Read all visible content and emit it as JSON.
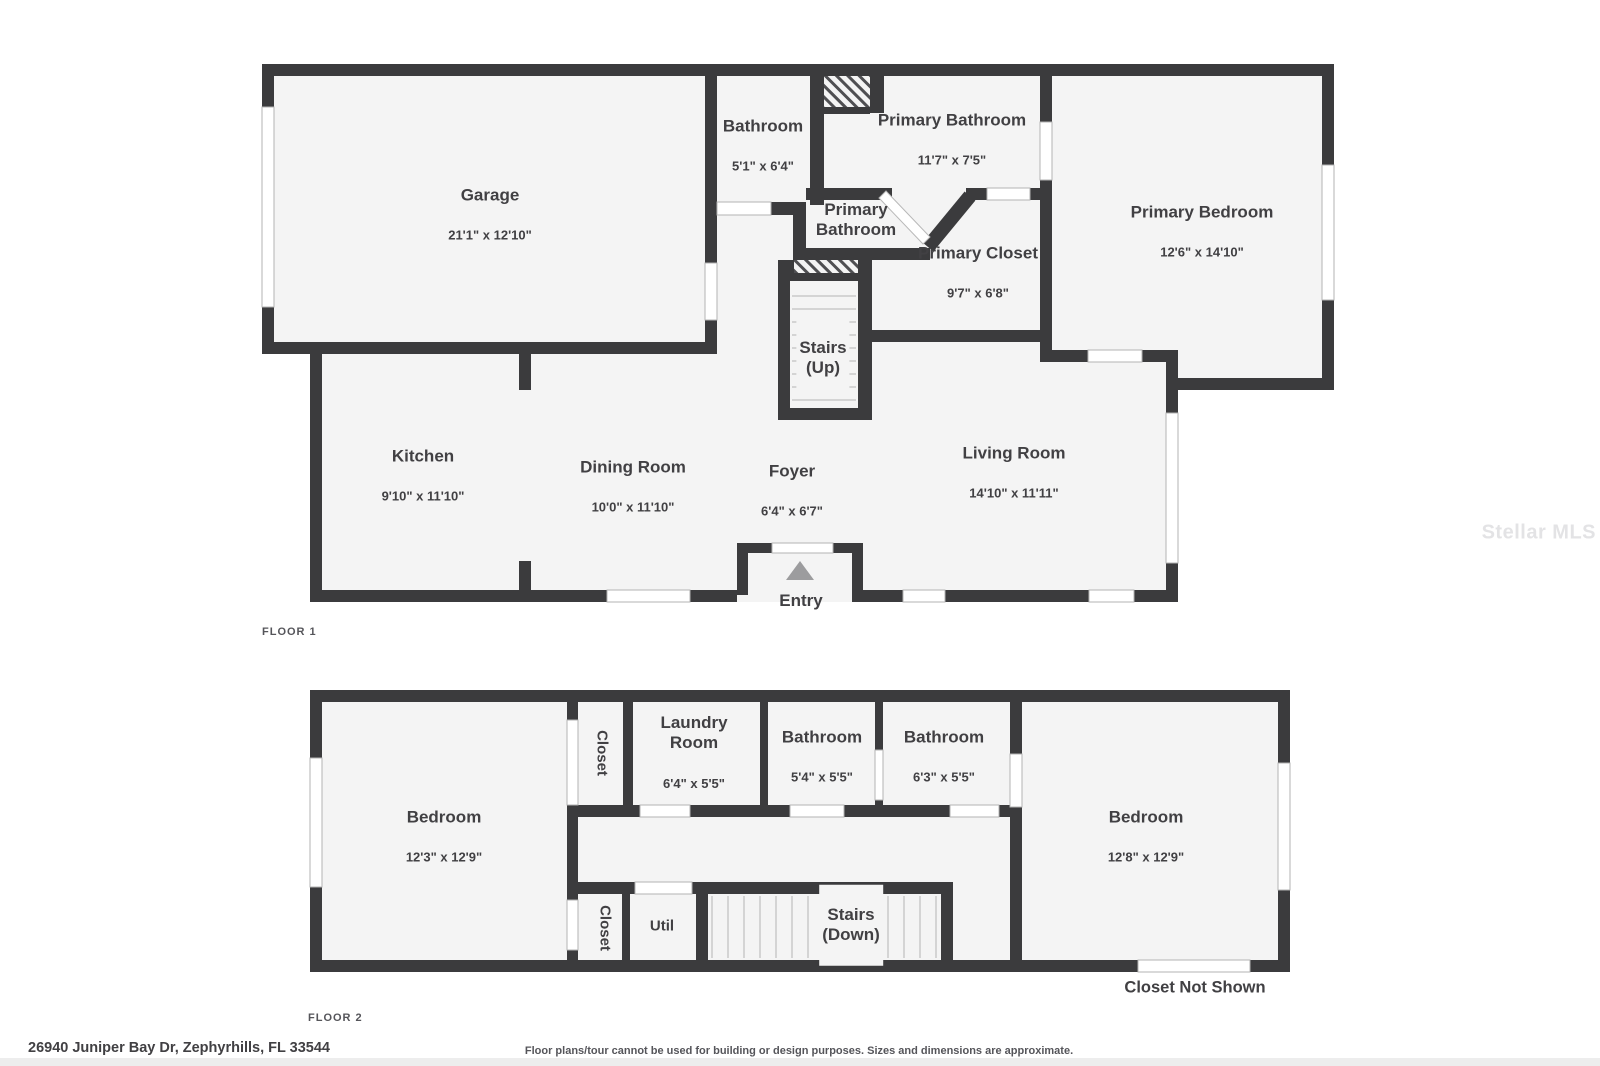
{
  "colors": {
    "wall": "#3b3b3d",
    "floor": "#f4f4f4",
    "window_line": "#b3b3b3",
    "stair_tread": "#c9c9c9",
    "text": "#414043",
    "muted_text": "#55555a",
    "hatch_line": "#4f4f52",
    "watermark": "#e3e3e5",
    "entry_triangle": "#9c9c9e",
    "door_swing": "#b8b8b8",
    "footer_bar": "#ededed"
  },
  "floor1": {
    "label": "FLOOR 1",
    "rooms": {
      "garage": {
        "name": "Garage",
        "dims": "21'1\" x 12'10\""
      },
      "bathroom": {
        "name": "Bathroom",
        "dims": "5'1\" x 6'4\""
      },
      "primary_bathroom": {
        "name": "Primary Bathroom",
        "dims": "11'7\" x 7'5\""
      },
      "primary_bathroom_small": {
        "name": "Primary\nBathroom"
      },
      "primary_closet": {
        "name": "Primary Closet",
        "dims": "9'7\" x 6'8\""
      },
      "primary_bedroom": {
        "name": "Primary Bedroom",
        "dims": "12'6\" x 14'10\""
      },
      "stairs": {
        "name": "Stairs\n(Up)"
      },
      "kitchen": {
        "name": "Kitchen",
        "dims": "9'10\" x 11'10\""
      },
      "dining": {
        "name": "Dining Room",
        "dims": "10'0\" x 11'10\""
      },
      "foyer": {
        "name": "Foyer",
        "dims": "6'4\" x 6'7\""
      },
      "living": {
        "name": "Living Room",
        "dims": "14'10\" x 11'11\""
      },
      "entry": {
        "name": "Entry"
      }
    }
  },
  "floor2": {
    "label": "FLOOR 2",
    "rooms": {
      "bedroom_left": {
        "name": "Bedroom",
        "dims": "12'3\" x 12'9\""
      },
      "closet_top": {
        "name": "Closet"
      },
      "laundry": {
        "name": "Laundry\nRoom",
        "dims": "6'4\" x 5'5\""
      },
      "bathroom_1": {
        "name": "Bathroom",
        "dims": "5'4\" x 5'5\""
      },
      "bathroom_2": {
        "name": "Bathroom",
        "dims": "6'3\" x 5'5\""
      },
      "bedroom_right": {
        "name": "Bedroom",
        "dims": "12'8\" x 12'9\""
      },
      "closet_bottom": {
        "name": "Closet"
      },
      "util": {
        "name": "Util"
      },
      "stairs": {
        "name": "Stairs\n(Down)"
      },
      "closet_note": "Closet Not Shown"
    }
  },
  "footer": {
    "address": "26940 Juniper Bay Dr, Zephyrhills, FL 33544",
    "disclaimer": "Floor plans/tour cannot be used for building or design purposes. Sizes and dimensions are approximate."
  },
  "watermark": "Stellar MLS"
}
